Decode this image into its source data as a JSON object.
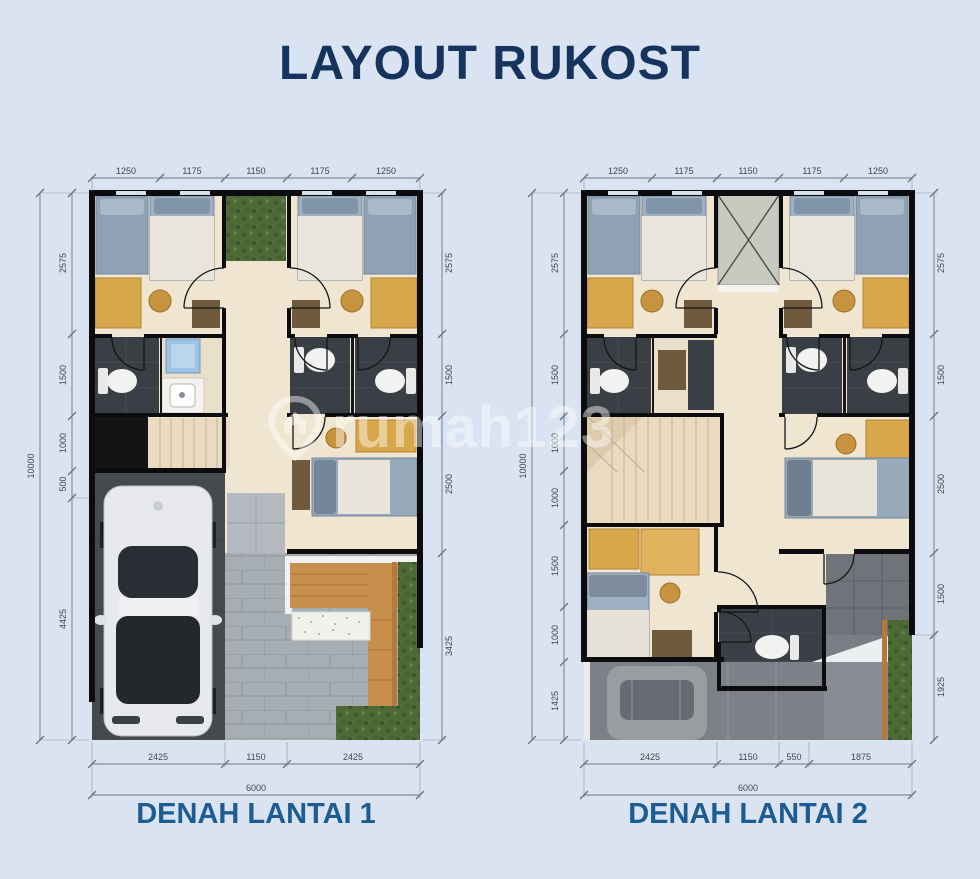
{
  "title": "LAYOUT RUKOST",
  "watermark": "rumah123",
  "plans": [
    {
      "label": "DENAH LANTAI 1",
      "dims_top": [
        "1250",
        "1175",
        "1150",
        "1175",
        "1250"
      ],
      "dims_left": [
        "2575",
        "1500",
        "1000",
        "500",
        "4425"
      ],
      "dim_left_total": "10000",
      "dims_right": [
        "2575",
        "1500",
        "2500",
        "3425"
      ],
      "dims_bottom": [
        "2425",
        "1150",
        "2425"
      ],
      "dim_bottom_total": "6000"
    },
    {
      "label": "DENAH LANTAI 2",
      "dims_top": [
        "1250",
        "1175",
        "1150",
        "1175",
        "1250"
      ],
      "dims_left": [
        "2575",
        "1500",
        "1000",
        "1000",
        "1500",
        "1000",
        "1425"
      ],
      "dim_left_total": "10000",
      "dims_right": [
        "2575",
        "1500",
        "2500",
        "1500",
        "1925"
      ],
      "dims_bottom": [
        "2425",
        "1150",
        "550",
        "1875"
      ],
      "dim_bottom_total": "6000"
    }
  ],
  "colors": {
    "background": "#d9e3f2",
    "title": "#16335e",
    "plan_label": "#1d5b93",
    "dimension": "#3d4957",
    "wall": "#0c0c0e",
    "floor": "#efe5d1",
    "bathroom": "#3a3e45",
    "wood": "#d7a74b",
    "green": "#4e6a37",
    "paver": "#a7aeb3"
  }
}
